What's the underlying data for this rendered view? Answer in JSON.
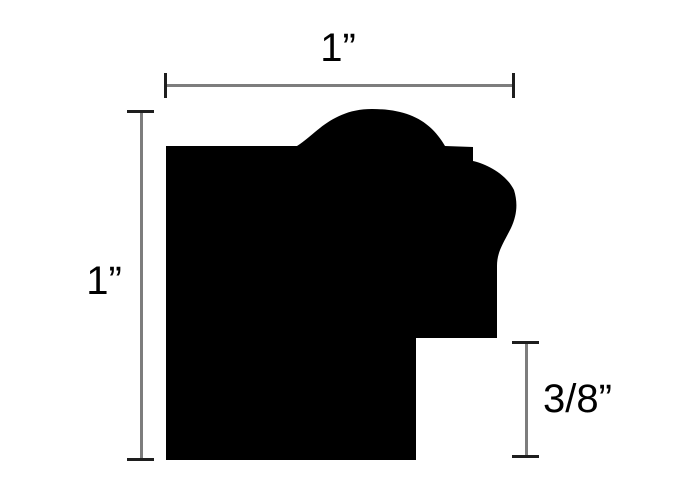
{
  "diagram": {
    "labels": {
      "width_top": "1”",
      "height_left": "1”",
      "rabbet_right": "3/8”"
    },
    "colors": {
      "profile_fill": "#000000",
      "dimension_line": "#7d7d7d",
      "dimension_tick": "#1e1e1e",
      "label_text": "#000000",
      "background": "#ffffff"
    }
  }
}
